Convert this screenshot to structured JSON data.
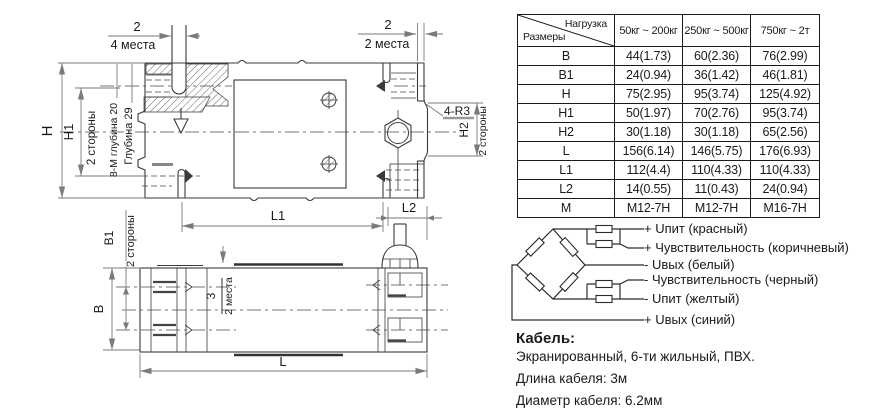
{
  "drawing": {
    "labels": {
      "dim2_left": "2",
      "places4": "4 места",
      "dim2_right": "2",
      "places2_right": "2 места",
      "h": "H",
      "h1": "H1",
      "sides_left": "2 стороны",
      "thread_note": "8-М глубина 20",
      "depth_note": "Глубина 29",
      "radius_note": "4-R3",
      "h2": "H2",
      "sides_h2": "2 стороны",
      "l1": "L1",
      "l2": "L2",
      "b1": "B1",
      "sides_b1": "2 стороны",
      "b": "B",
      "dim3": "3",
      "places2_bottom": "2 места",
      "l": "L"
    }
  },
  "table": {
    "header": {
      "load": "Нагрузка",
      "size": "Размеры",
      "cols": [
        "50кг ~ 200кг",
        "250кг ~ 500кг",
        "750кг ~ 2т"
      ]
    },
    "rows": [
      {
        "name": "B",
        "values": [
          "44(1.73)",
          "60(2.36)",
          "76(2.99)"
        ]
      },
      {
        "name": "B1",
        "values": [
          "24(0.94)",
          "36(1.42)",
          "46(1.81)"
        ]
      },
      {
        "name": "H",
        "values": [
          "75(2.95)",
          "95(3.74)",
          "125(4.92)"
        ]
      },
      {
        "name": "H1",
        "values": [
          "50(1.97)",
          "70(2.76)",
          "95(3.74)"
        ]
      },
      {
        "name": "H2",
        "values": [
          "30(1.18)",
          "30(1.18)",
          "65(2.56)"
        ]
      },
      {
        "name": "L",
        "values": [
          "156(6.14)",
          "146(5.75)",
          "176(6.93)"
        ]
      },
      {
        "name": "L1",
        "values": [
          "112(4.4)",
          "110(4.33)",
          "110(4.33)"
        ]
      },
      {
        "name": "L2",
        "values": [
          "14(0.55)",
          "11(0.43)",
          "24(0.94)"
        ]
      },
      {
        "name": "M",
        "values": [
          "M12-7H",
          "M12-7H",
          "M16-7H"
        ]
      }
    ]
  },
  "wiring": {
    "labels": [
      "+ Uпит (красный)",
      "+ Чувствительность (коричневый)",
      "-  Uвых (белый)",
      "-  Чувствительность (черный)",
      "-  Uпит (желтый)",
      "+ Uвых (синий)"
    ]
  },
  "cable": {
    "title": "Кабель:",
    "spec": "Экранированный, 6-ти жильный, ПВХ.",
    "length": "Длина кабеля: 3м",
    "diameter": "Диаметр кабеля:  6.2мм"
  },
  "colors": {
    "ink": "#3a3a3a",
    "dimension": "#7a7a7a",
    "background": "#ffffff"
  }
}
